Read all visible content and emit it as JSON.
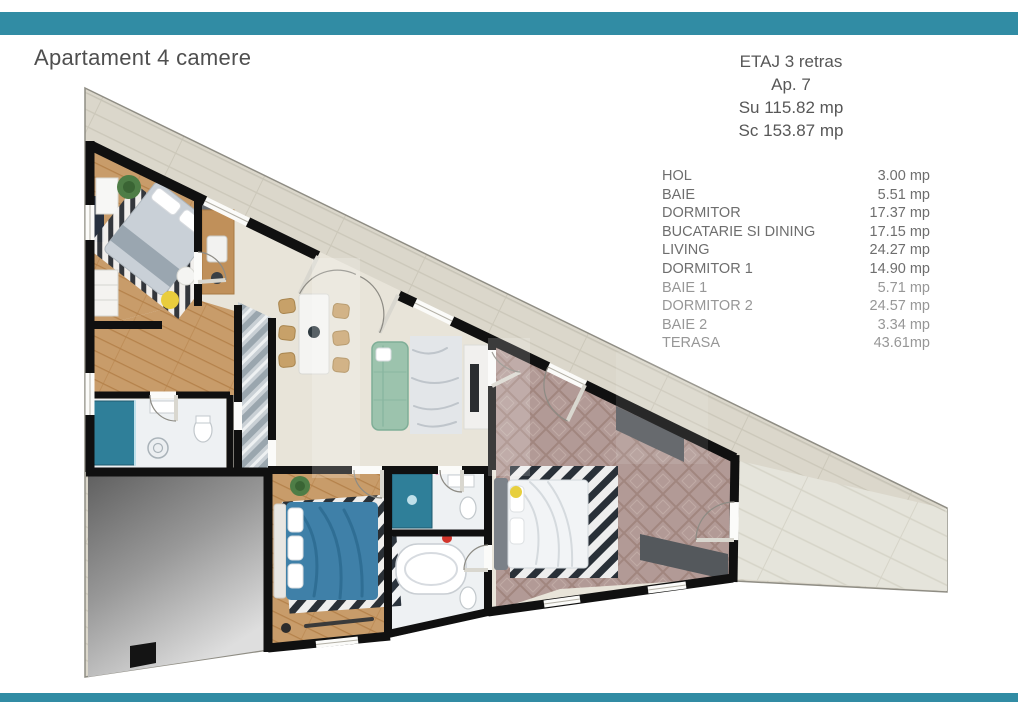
{
  "title": "Apartament 4 camere",
  "header": {
    "etaj": "ETAJ 3 retras",
    "ap": "Ap. 7",
    "su": "Su 115.82 mp",
    "sc": "Sc 153.87 mp"
  },
  "room_list": {
    "rows": [
      {
        "label": "HOL",
        "area": "3.00 mp"
      },
      {
        "label": "BAIE",
        "area": "5.51 mp"
      },
      {
        "label": "DORMITOR",
        "area": "17.37 mp"
      },
      {
        "label": "BUCATARIE SI DINING",
        "area": "17.15 mp"
      },
      {
        "label": "LIVING",
        "area": "24.27 mp"
      },
      {
        "label": "DORMITOR 1",
        "area": "14.90 mp"
      },
      {
        "label": "BAIE 1",
        "area": "5.71 mp"
      },
      {
        "label": "DORMITOR 2",
        "area": "24.57 mp"
      },
      {
        "label": "BAIE 2",
        "area": "3.34 mp"
      },
      {
        "label": "TERASA",
        "area": "43.61mp"
      }
    ]
  },
  "floor_plan": {
    "kind": "triangular wedge apartment, top-down 3D render",
    "colors": {
      "accent_teal": "#318ca4",
      "walls": "#101010",
      "terrace_floor": "#dbd7cb",
      "living_floor": "#e8e4d9",
      "wood_floor": "#c89c6a",
      "bedroom2_floor": "#b29a96",
      "hall_tile": "#c9d0d5",
      "bathroom_floor": "#eef1f3",
      "sofa_green": "#9cc3ad",
      "bed_blue": "#3f80a8",
      "shower_teal": "#2f7f99"
    }
  }
}
